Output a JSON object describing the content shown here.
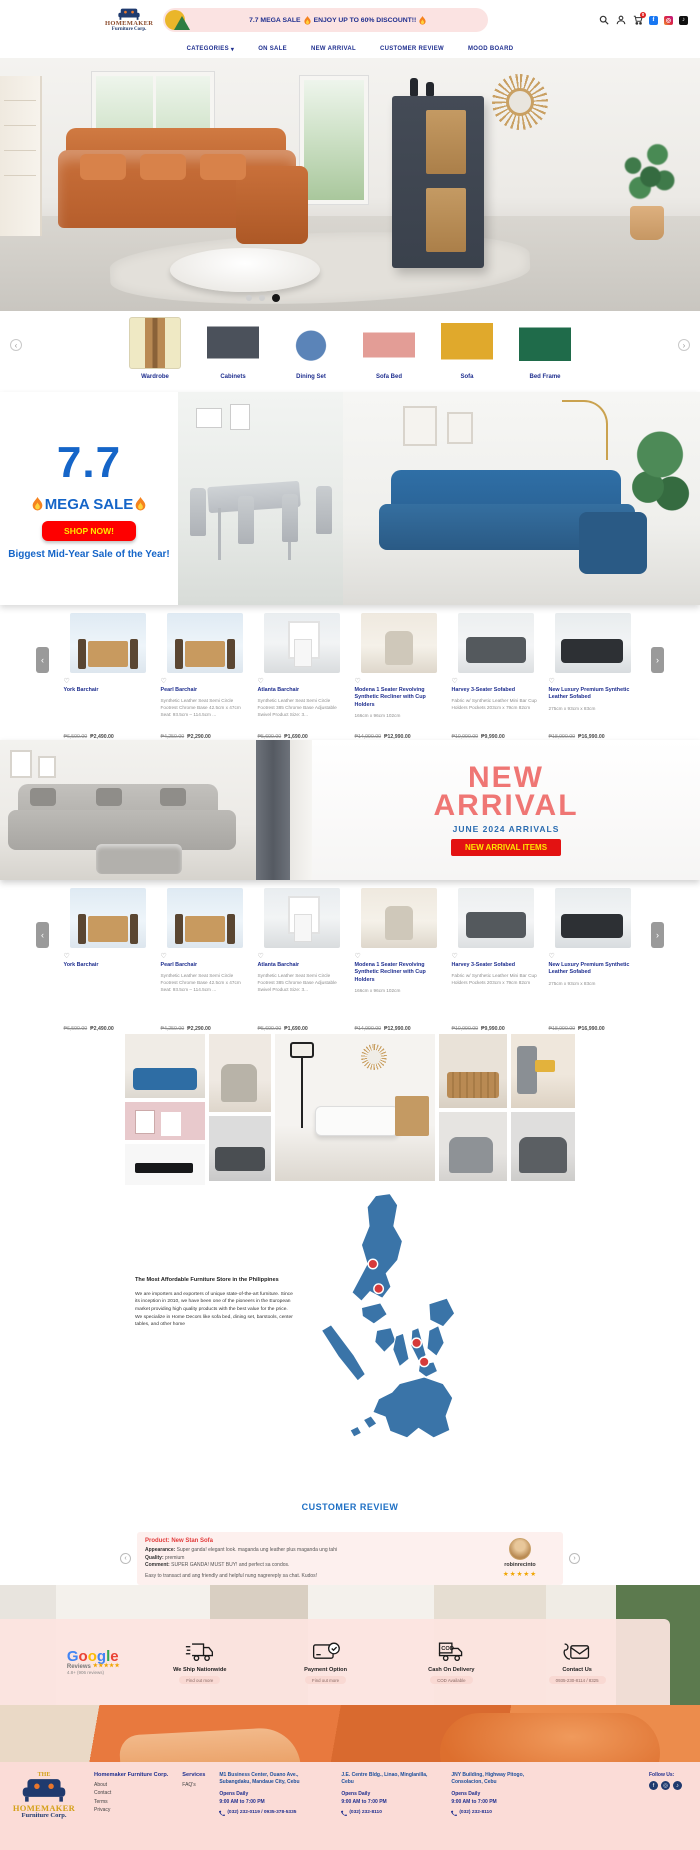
{
  "icons": {
    "heart": "♡",
    "chevron_left": "‹",
    "chevron_right": "›",
    "chevron_down": "▾"
  },
  "header": {
    "logo_line1": "HOMEMAKER",
    "logo_line2": "Furniture Corp.",
    "sale_text_1": "7.7 MEGA SALE",
    "sale_text_2": "ENJOY UP TO 60% DISCOUNT!!",
    "cart_badge": "0",
    "social_fb": "f",
    "social_ig": "◎",
    "social_tk": "♪",
    "nav": {
      "categories": "CATEGORIES",
      "on_sale": "ON SALE",
      "new_arrival": "NEW ARRIVAL",
      "customer_review": "CUSTOMER REVIEW",
      "mood_board": "MOOD BOARD"
    }
  },
  "categories": {
    "items": [
      {
        "label": "Wardrobe"
      },
      {
        "label": "Cabinets"
      },
      {
        "label": "Dining Set"
      },
      {
        "label": "Sofa Bed"
      },
      {
        "label": "Sofa"
      },
      {
        "label": "Bed Frame"
      }
    ]
  },
  "mega_sale": {
    "number": "7.7",
    "title": "MEGA SALE",
    "cta": "SHOP NOW!",
    "subtitle": "Biggest Mid-Year Sale of the Year!"
  },
  "products": [
    {
      "name": "York Barchair",
      "desc": "",
      "old_price": "₱6,590.00",
      "price": "₱2,490.00"
    },
    {
      "name": "Pearl Barchair",
      "desc": "Synthetic Leather Seat Semi Circle Footrest Chrome Base 42.5cm x 47cm Seat: 93.5cm – 114.5cm ...",
      "old_price": "₱4,250.00",
      "price": "₱2,290.00"
    },
    {
      "name": "Atlanta Barchair",
      "desc": "Synthetic Leather Seat Semi Circle Footrest 385 Chrome Base Adjustable Swivel Product Size: 3...",
      "old_price": "₱5,690.00",
      "price": "₱1,690.00"
    },
    {
      "name": "Modena 1 Seater Revolving Synthetic Recliner with Cup Holders",
      "desc": "166cm x 96cm 102cm",
      "old_price": "₱14,990.00",
      "price": "₱12,990.00"
    },
    {
      "name": "Harvey 3-Seater Sofabed",
      "desc": "Fabric w/ Synthetic Leather Mini Bar Cup Holders Pockets 203cm x 79cm 82cm",
      "old_price": "₱10,990.00",
      "price": "₱9,990.00"
    },
    {
      "name": "New Luxury Premium Synthetic Leather Sofabed",
      "desc": "275cm x 93cm x 83cm",
      "old_price": "₱18,990.00",
      "price": "₱16,990.00"
    }
  ],
  "new_arrival": {
    "title_line1": "NEW",
    "title_line2": "ARRIVAL",
    "subtitle": "JUNE 2024 ARRIVALS",
    "cta": "NEW ARRIVAL ITEMS"
  },
  "about": {
    "title": "The Most Affordable Furniture Store in the Philippines",
    "body1": "We are importers and exporters of unique state-of-the-art furniture. Since its inception in 2010, we have been one of the pioneers in the European market providing high quality products with the best value for the price.",
    "body2": "We specialize in Home Decors like sofa bed, dining set, barstools, center tables, and other home"
  },
  "review": {
    "heading": "CUSTOMER REVIEW",
    "product": "Product: New Stan Sofa",
    "appearance_label": "Appearance:",
    "appearance_text": " Super ganda! elegant look. maganda ung leather plus maganda ung tahi",
    "quality_label": "Quality:",
    "quality_text": " premium",
    "comment_label": "Comment:",
    "comment_text": " SUPER GANDA! MUST BUY! and perfect sa condos.",
    "extra_text": "Easy to transact and ang friendly and helpful nung nagrereply sa chat. Kudos!",
    "reviewer": "robinrecinto",
    "stars": "★★★★★"
  },
  "services": {
    "google_letters": [
      "G",
      "o",
      "o",
      "g",
      "l",
      "e"
    ],
    "google_line2": "Reviews",
    "google_stars": "★★★★★",
    "google_rating": "4.8+ (906 reviews)",
    "items": [
      {
        "title": "We Ship Nationwide",
        "sub": "Find out more"
      },
      {
        "title": "Payment Option",
        "sub": "Find out more"
      },
      {
        "title": "Cash On Delivery",
        "sub": "COD Available"
      },
      {
        "title": "Contact Us",
        "sub": "0935-230-8114 / 8325"
      }
    ]
  },
  "footer": {
    "logo_the": "THE",
    "logo_line1": "HOMEMAKER",
    "logo_line2": "Furniture Corp.",
    "company": "Homemaker Furniture Corp.",
    "company_links": [
      "About",
      "Contact",
      "Terms",
      "Privacy"
    ],
    "services_title": "Services",
    "faq": "FAQ's",
    "branches": [
      {
        "address": "M1 Business Center, Ouano Ave., Subangdaku, Mandaue City, Cebu",
        "opens1": "Opens Daily",
        "opens2": "9:00 AM to 7:00 PM",
        "phone": "(032) 232-0119 / 0935-378-5335"
      },
      {
        "address": "J.E. Centre Bldg., Linao, Minglanilla, Cebu",
        "opens1": "Opens Daily",
        "opens2": "9:00 AM to 7:00 PM",
        "phone": "(032) 232-8110"
      },
      {
        "address": "JNY Building, Highway Pitogo, Consolacion, Cebu",
        "opens1": "Opens Daily",
        "opens2": "9:00 AM to 7:00 PM",
        "phone": "(032) 232-8110"
      }
    ],
    "follow": "Follow Us:",
    "social_fb": "f",
    "social_ig": "◎",
    "social_tk": "♪"
  }
}
